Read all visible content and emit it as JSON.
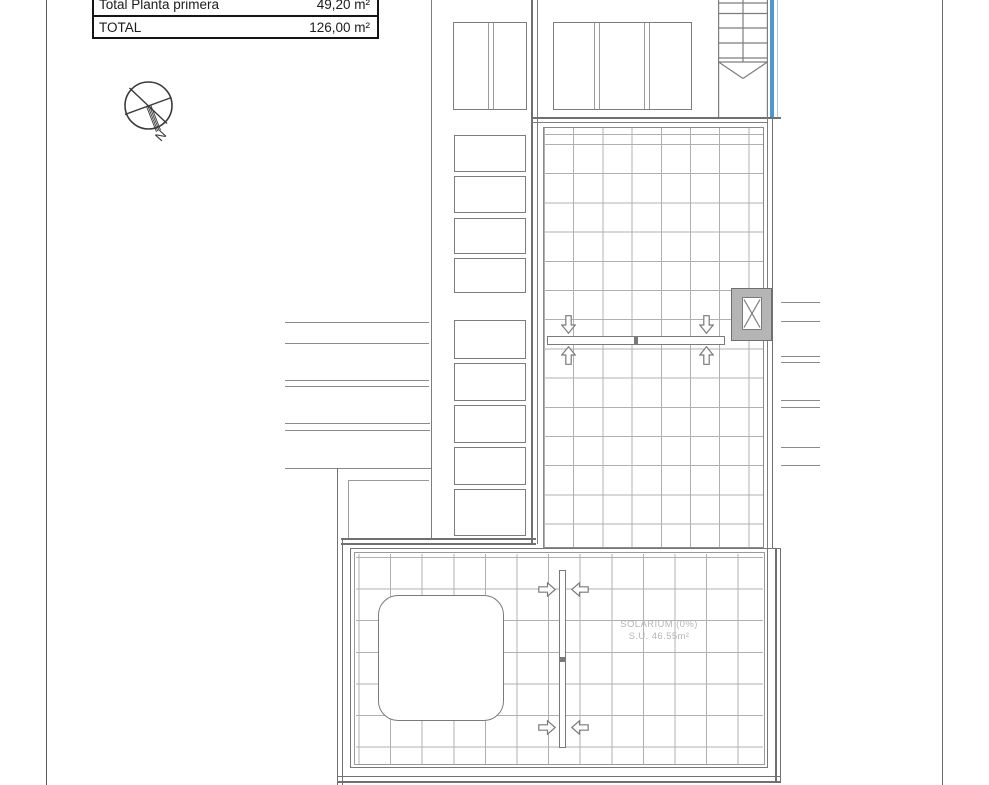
{
  "title_block": {
    "rows": [
      {
        "label": "Total Planta primera",
        "value": "49,20 m²"
      },
      {
        "label": "TOTAL",
        "value": "126,00 m²"
      }
    ]
  },
  "compass": {
    "north_label": "N"
  },
  "solarium_label": {
    "line1": "SOLARIUM (0%)",
    "line2": "S.U. 46.55m²"
  },
  "colors": {
    "accent_blue": "#4f97d3",
    "light_blue": "#b3c6d6",
    "wall_line": "#707070",
    "frame_line": "#7a7a7a",
    "grid_line": "#b0b0b0",
    "muted_text": "#b6b6b6",
    "vent_box_fill": "#b5b5b5",
    "table_text": "#1c1c1c"
  }
}
